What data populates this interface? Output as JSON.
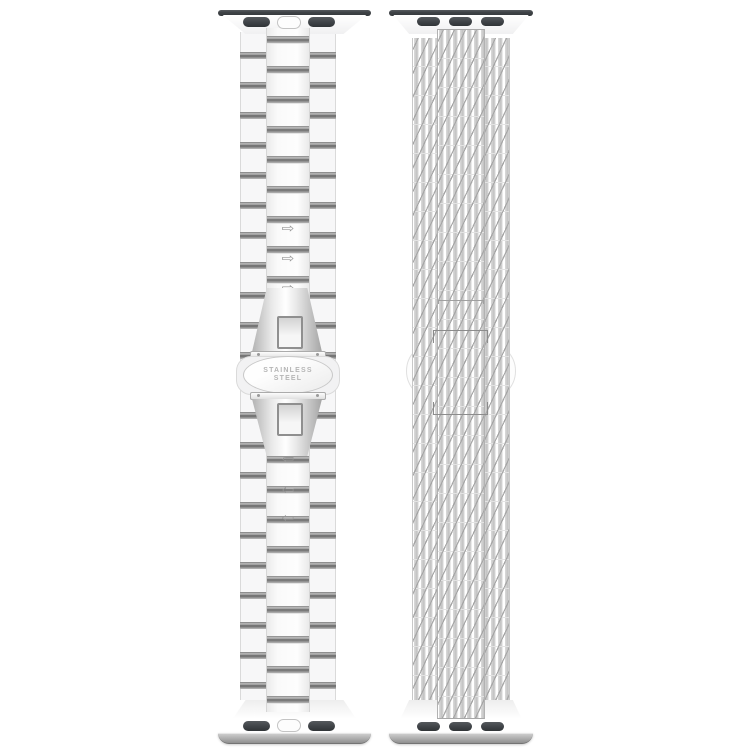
{
  "product": {
    "left_band": {
      "type": "stainless steel link band",
      "lug_slot_count": "2",
      "clasp": {
        "engraving_line1": "STAINLESS",
        "engraving_line2": "STEEL"
      },
      "arrow_up_glyph": "⇨",
      "arrow_down_glyph": "⇦"
    },
    "right_band": {
      "type": "woven mesh loop band",
      "lug_slot_count": "3"
    },
    "colors": {
      "background": "#ffffff",
      "lug_slot_dark": "#3f4347",
      "steel_link_shadow": "#7a7a7a",
      "steel_base_gray": "#9a9a9a",
      "mesh_stripe": "#c5c5c5",
      "mesh_diagonal": "#a6a6a6",
      "engraving_text": "#b5b5b5"
    }
  }
}
